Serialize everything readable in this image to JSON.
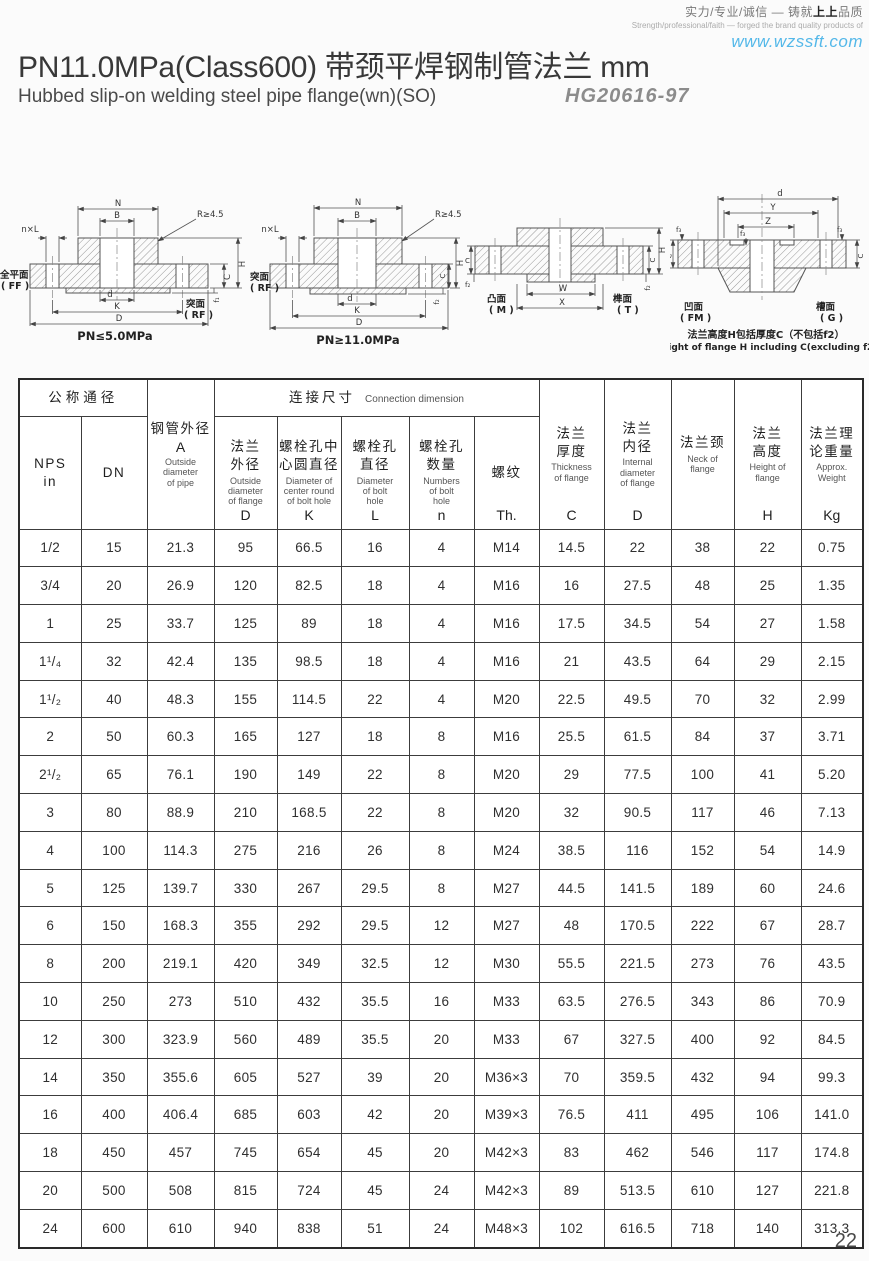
{
  "header": {
    "slogan_cn_pre": "实力/专业/诚信 — 铸就",
    "slogan_cn_bold": "上上",
    "slogan_cn_post": "品质",
    "slogan_en": "Strength/professional/faith — forged the brand quality products of",
    "website": "www.wzssft.com",
    "website_color": "#54b8e9"
  },
  "title": {
    "main": "PN11.0MPa(Class600) 带颈平焊钢制管法兰  mm",
    "subtitle": "Hubbed slip-on welding steel pipe flange(wn)(SO)",
    "standard": "HG20616-97"
  },
  "drawings": {
    "fig1": {
      "caption": "PN≤5.0MPa",
      "face_left_cn": "全平面",
      "face_left_code": "( FF )",
      "face_right_cn": "突面",
      "face_right_code": "( RF )",
      "dim_N": "N",
      "dim_B": "B",
      "dim_R": "R≥4.5",
      "dim_nxL": "n×L",
      "dim_d": "d",
      "dim_K": "K",
      "dim_D": "D",
      "dim_H": "H",
      "dim_C": "C",
      "dim_f": "f₁"
    },
    "fig2": {
      "caption": "PN≥11.0MPa",
      "face_left_cn": "突面",
      "face_left_code": "( RF )",
      "dim_N": "N",
      "dim_B": "B",
      "dim_R": "R≥4.5",
      "dim_nxL": "n×L",
      "dim_d": "d",
      "dim_K": "K",
      "dim_D": "D",
      "dim_H": "H",
      "dim_C": "C",
      "dim_f": "f₂"
    },
    "fig3": {
      "face_left_cn": "凸面",
      "face_left_code": "( M )",
      "face_right_cn": "榫面",
      "face_right_code": "( T )",
      "dim_W": "W",
      "dim_X": "X",
      "dim_H": "H",
      "dim_C": "C",
      "dim_Cr": "C",
      "dim_f": "f₂",
      "dim_fr": "f₂"
    },
    "fig4": {
      "face_left_cn": "凹面",
      "face_left_code": "( FM )",
      "face_right_cn": "槽面",
      "face_right_code": "( G )",
      "dim_d": "d",
      "dim_Y": "Y",
      "dim_Z": "Z",
      "dim_f": "f₃",
      "dim_C": "C",
      "dim_Cr": "C",
      "caption_cn": "法兰高度H包括厚度C（不包括f2）",
      "caption_en": "Height of flange H including C(excluding f2)"
    }
  },
  "table": {
    "group_nominal": "公称通径",
    "group_connection_cn": "连接尺寸",
    "group_connection_en": "Connection dimension",
    "cols": {
      "nps": {
        "cn": "NPS\nin"
      },
      "dn": {
        "cn": "DN"
      },
      "a": {
        "cn": "钢管外径",
        "sym": "A",
        "en": "Outside\ndiameter\nof pipe"
      },
      "d_out": {
        "cn": "法兰\n外径",
        "en": "Outside\ndiameter\nof flange",
        "sym": "D"
      },
      "k": {
        "cn": "螺栓孔中\n心圆直径",
        "en": "Diameter of\ncenter round\nof bolt hole",
        "sym": "K"
      },
      "l": {
        "cn": "螺栓孔\n直径",
        "en": "Diameter\nof bolt\nhole",
        "sym": "L"
      },
      "n": {
        "cn": "螺栓孔\n数量",
        "en": "Numbers\nof bolt\nhole",
        "sym": "n"
      },
      "th": {
        "cn": "螺纹",
        "sym": "Th."
      },
      "c": {
        "cn": "法兰\n厚度",
        "en": "Thickness\nof flange",
        "sym": "C"
      },
      "d_in": {
        "cn": "法兰\n内径",
        "en": "Internal\ndiameter\nof flange",
        "sym": "D"
      },
      "neck": {
        "cn": "法兰颈",
        "en": "Neck of\nflange"
      },
      "h": {
        "cn": "法兰\n高度",
        "en": "Height of\nflange",
        "sym": "H"
      },
      "kg": {
        "cn": "法兰理\n论重量",
        "en": "Approx.\nWeight",
        "sym": "Kg"
      }
    },
    "rows": [
      [
        "1/2",
        "15",
        "21.3",
        "95",
        "66.5",
        "16",
        "4",
        "M14",
        "14.5",
        "22",
        "38",
        "22",
        "0.75"
      ],
      [
        "3/4",
        "20",
        "26.9",
        "120",
        "82.5",
        "18",
        "4",
        "M16",
        "16",
        "27.5",
        "48",
        "25",
        "1.35"
      ],
      [
        "1",
        "25",
        "33.7",
        "125",
        "89",
        "18",
        "4",
        "M16",
        "17.5",
        "34.5",
        "54",
        "27",
        "1.58"
      ],
      [
        "1¹/₄",
        "32",
        "42.4",
        "135",
        "98.5",
        "18",
        "4",
        "M16",
        "21",
        "43.5",
        "64",
        "29",
        "2.15"
      ],
      [
        "1¹/₂",
        "40",
        "48.3",
        "155",
        "114.5",
        "22",
        "4",
        "M20",
        "22.5",
        "49.5",
        "70",
        "32",
        "2.99"
      ],
      [
        "2",
        "50",
        "60.3",
        "165",
        "127",
        "18",
        "8",
        "M16",
        "25.5",
        "61.5",
        "84",
        "37",
        "3.71"
      ],
      [
        "2¹/₂",
        "65",
        "76.1",
        "190",
        "149",
        "22",
        "8",
        "M20",
        "29",
        "77.5",
        "100",
        "41",
        "5.20"
      ],
      [
        "3",
        "80",
        "88.9",
        "210",
        "168.5",
        "22",
        "8",
        "M20",
        "32",
        "90.5",
        "117",
        "46",
        "7.13"
      ],
      [
        "4",
        "100",
        "114.3",
        "275",
        "216",
        "26",
        "8",
        "M24",
        "38.5",
        "116",
        "152",
        "54",
        "14.9"
      ],
      [
        "5",
        "125",
        "139.7",
        "330",
        "267",
        "29.5",
        "8",
        "M27",
        "44.5",
        "141.5",
        "189",
        "60",
        "24.6"
      ],
      [
        "6",
        "150",
        "168.3",
        "355",
        "292",
        "29.5",
        "12",
        "M27",
        "48",
        "170.5",
        "222",
        "67",
        "28.7"
      ],
      [
        "8",
        "200",
        "219.1",
        "420",
        "349",
        "32.5",
        "12",
        "M30",
        "55.5",
        "221.5",
        "273",
        "76",
        "43.5"
      ],
      [
        "10",
        "250",
        "273",
        "510",
        "432",
        "35.5",
        "16",
        "M33",
        "63.5",
        "276.5",
        "343",
        "86",
        "70.9"
      ],
      [
        "12",
        "300",
        "323.9",
        "560",
        "489",
        "35.5",
        "20",
        "M33",
        "67",
        "327.5",
        "400",
        "92",
        "84.5"
      ],
      [
        "14",
        "350",
        "355.6",
        "605",
        "527",
        "39",
        "20",
        "M36×3",
        "70",
        "359.5",
        "432",
        "94",
        "99.3"
      ],
      [
        "16",
        "400",
        "406.4",
        "685",
        "603",
        "42",
        "20",
        "M39×3",
        "76.5",
        "411",
        "495",
        "106",
        "141.0"
      ],
      [
        "18",
        "450",
        "457",
        "745",
        "654",
        "45",
        "20",
        "M42×3",
        "83",
        "462",
        "546",
        "117",
        "174.8"
      ],
      [
        "20",
        "500",
        "508",
        "815",
        "724",
        "45",
        "24",
        "M42×3",
        "89",
        "513.5",
        "610",
        "127",
        "221.8"
      ],
      [
        "24",
        "600",
        "610",
        "940",
        "838",
        "51",
        "24",
        "M48×3",
        "102",
        "616.5",
        "718",
        "140",
        "313.3"
      ]
    ]
  },
  "page_number": "22"
}
